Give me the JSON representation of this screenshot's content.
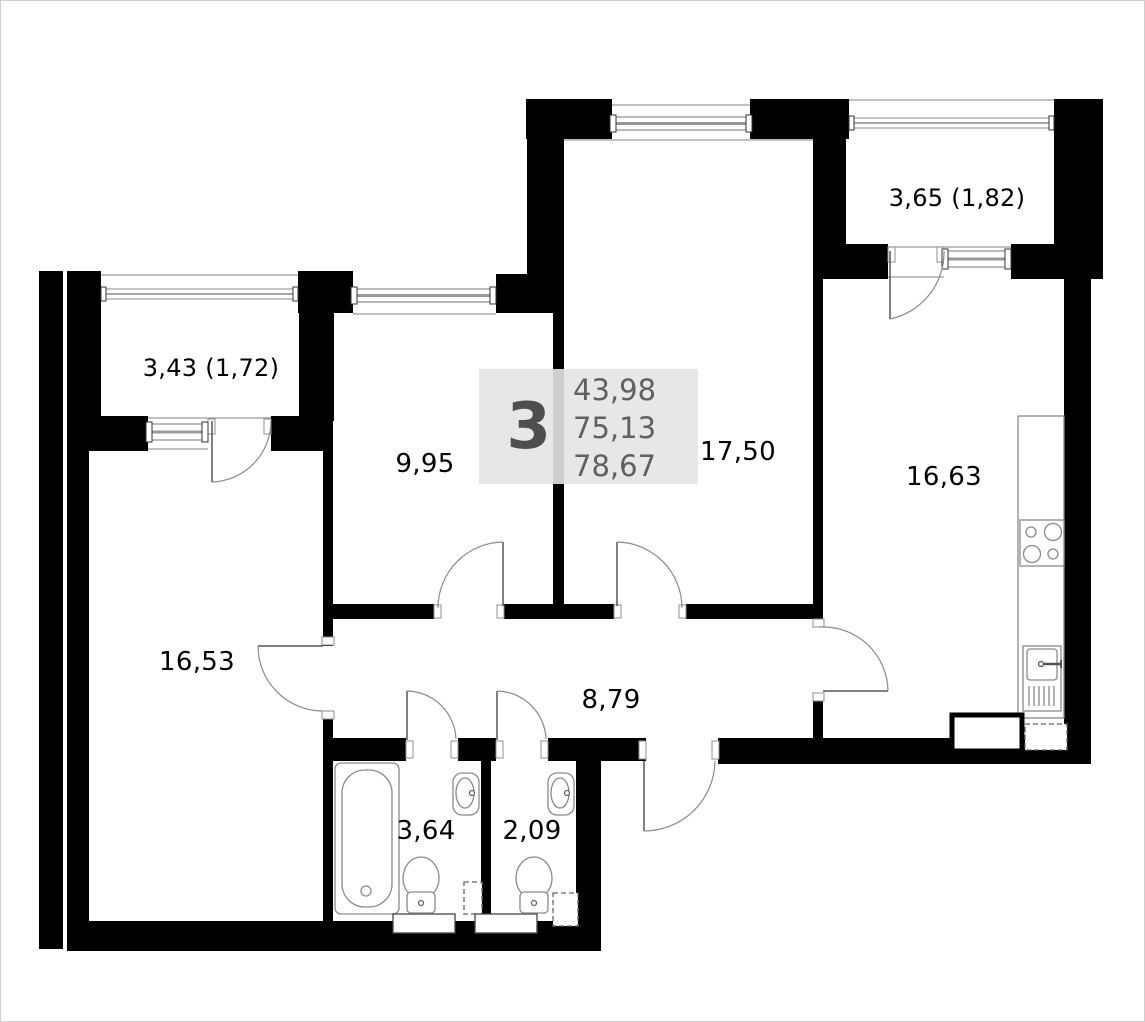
{
  "plan": {
    "unit_badge": {
      "rooms_count": "3",
      "areas": [
        "43,98",
        "75,13",
        "78,67"
      ]
    },
    "rooms": [
      {
        "id": "balcony-right",
        "label": "3,65 (1,82)"
      },
      {
        "id": "balcony-left",
        "label": "3,43 (1,72)"
      },
      {
        "id": "room-middle",
        "label": "9,95"
      },
      {
        "id": "living-room",
        "label": "17,50"
      },
      {
        "id": "kitchen",
        "label": "16,63"
      },
      {
        "id": "room-left",
        "label": "16,53"
      },
      {
        "id": "hallway",
        "label": "8,79"
      },
      {
        "id": "bathroom",
        "label": "3,64"
      },
      {
        "id": "wc",
        "label": "2,09"
      }
    ],
    "colors": {
      "wall": "#000000",
      "thin_line": "#8a8a8a",
      "badge_bg": "#e4e4e4",
      "badge_text": "#606060",
      "label_text": "#000000"
    }
  }
}
